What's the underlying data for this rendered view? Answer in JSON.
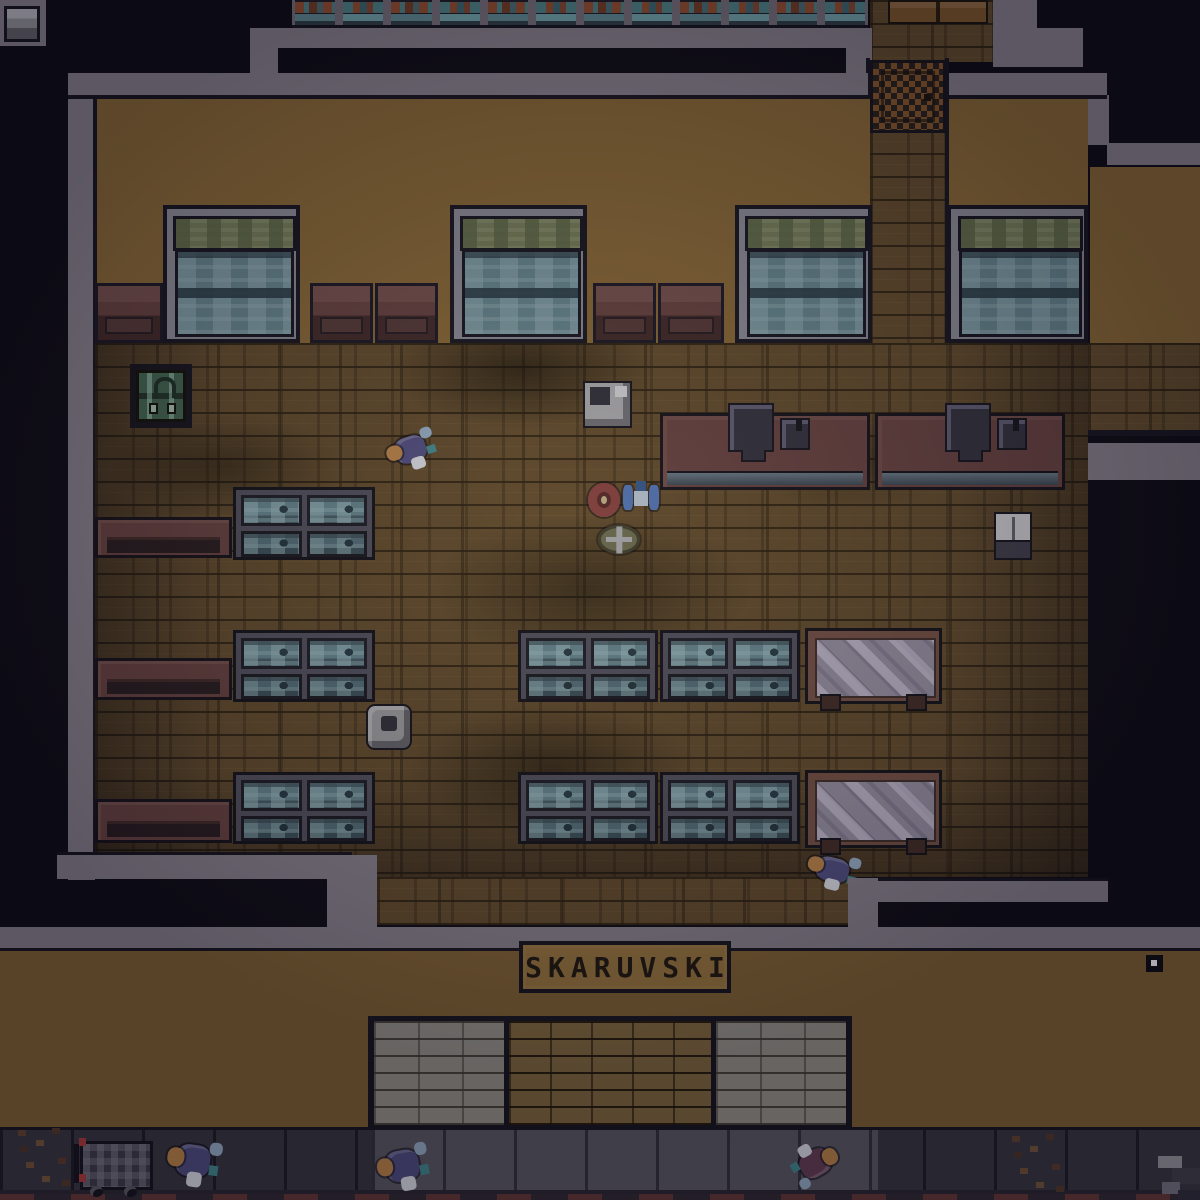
{
  "meta": {
    "scene": "top-down pixel-art city shop at night",
    "shop_name": "SKARUVSKI"
  },
  "sign": {
    "text": "SKARUVSKI"
  },
  "palette": {
    "outside": "#0d0b15",
    "wallGray": "#7b7580",
    "wallGrayDark": "#6b6570",
    "tan": "#7d5f33",
    "facadeTan": "#755931",
    "wood": "#5a452a",
    "maroon": "#5e3c3c",
    "glassTeal": "#5d7a84",
    "glassOlive": "#6d7454",
    "tableGlass": "#8a8496",
    "tableFrame": "#6b4a40",
    "sidewalkLight": "#55525e",
    "sidewalkDark": "#34323c",
    "entryLight": "#8a8781",
    "entryBrown": "#77603b",
    "rugOrange": "#7c4f28",
    "rugDark": "#241e1c",
    "signBg": "#8a6a3a",
    "signText": "#1c1610",
    "charPurple": "#4a4878",
    "charOrange": "#ad7a44",
    "charBlue": "#4a6aa8",
    "charRed": "#7a3a3a",
    "registerDark": "#2e2d3a",
    "chestGreen": "#3d5c4c",
    "outline": "#16141f"
  },
  "entities": {
    "shop": {
      "windows": 4,
      "display_cases": 6,
      "glass_tables": 2,
      "wall_benches": 3,
      "wall_cabinets": 5,
      "checkout_counters": 2,
      "cash_registers": 4,
      "doormat_rug": 1,
      "green_chest": 1,
      "trash_can": 1,
      "white_fridge": 1,
      "gray_machine": 1
    },
    "characters": [
      {
        "name": "shopper",
        "location": "shop floor upper-left"
      },
      {
        "name": "shopper",
        "location": "shop floor lower-right"
      },
      {
        "name": "pedestrian",
        "location": "sidewalk left"
      },
      {
        "name": "pedestrian",
        "location": "sidewalk center"
      },
      {
        "name": "pedestrian",
        "location": "sidewalk right"
      }
    ],
    "floor_items": [
      {
        "name": "red-ring-item"
      },
      {
        "name": "blue-bundle-item"
      },
      {
        "name": "olive-sack-item"
      }
    ],
    "street_props": [
      {
        "name": "shopping-cart"
      },
      {
        "name": "leaf-debris-left"
      },
      {
        "name": "leaf-debris-right"
      },
      {
        "name": "junk-pile-edge"
      },
      {
        "name": "wall-marker-dot"
      }
    ]
  }
}
